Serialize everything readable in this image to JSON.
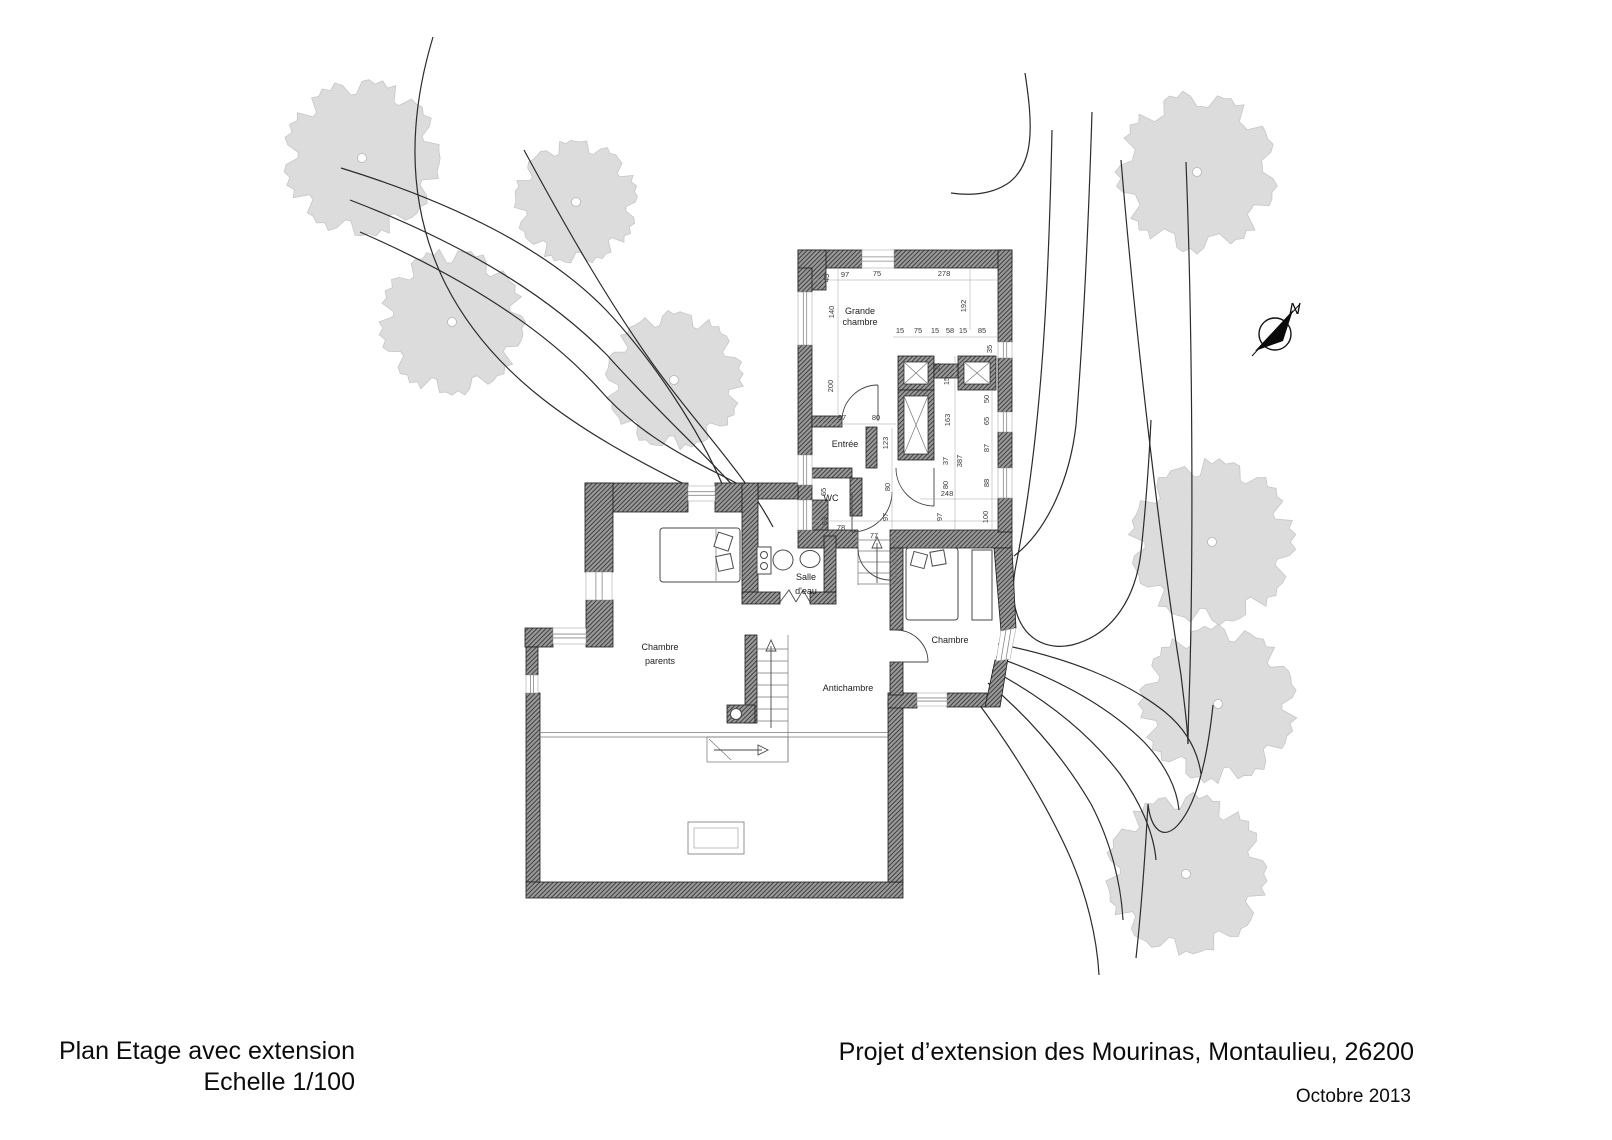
{
  "page": {
    "plan_title_line1": "Plan Etage avec extension",
    "plan_title_line2": "Echelle 1/100",
    "project_title": "Projet d’extension des Mourinas, Montaulieu, 26200",
    "date": "Octobre 2013"
  },
  "compass": {
    "label": "N"
  },
  "room_labels": [
    {
      "lines": [
        "Grande",
        "chambre"
      ],
      "x": 860,
      "y": 314,
      "lh": 11
    },
    {
      "lines": [
        "Entrée"
      ],
      "x": 845,
      "y": 447,
      "lh": 11
    },
    {
      "lines": [
        "WC"
      ],
      "x": 831,
      "y": 501,
      "lh": 11
    },
    {
      "lines": [
        "Salle",
        "d'eau"
      ],
      "x": 806,
      "y": 580,
      "lh": 14
    },
    {
      "lines": [
        "Chambre",
        "parents"
      ],
      "x": 660,
      "y": 650,
      "lh": 14
    },
    {
      "lines": [
        "Antichambre"
      ],
      "x": 848,
      "y": 691,
      "lh": 11
    },
    {
      "lines": [
        "Chambre"
      ],
      "x": 950,
      "y": 643,
      "lh": 11
    }
  ],
  "dimensions": [
    {
      "t": "43",
      "x": 829,
      "y": 278,
      "v": 1
    },
    {
      "t": "97",
      "x": 845,
      "y": 277
    },
    {
      "t": "75",
      "x": 877,
      "y": 276
    },
    {
      "t": "278",
      "x": 944,
      "y": 276
    },
    {
      "t": "140",
      "x": 834,
      "y": 312,
      "v": 1
    },
    {
      "t": "192",
      "x": 966,
      "y": 306,
      "v": 1
    },
    {
      "t": "200",
      "x": 833,
      "y": 386,
      "v": 1
    },
    {
      "t": "15",
      "x": 900,
      "y": 333
    },
    {
      "t": "75",
      "x": 918,
      "y": 333
    },
    {
      "t": "15",
      "x": 935,
      "y": 333
    },
    {
      "t": "58",
      "x": 950,
      "y": 333
    },
    {
      "t": "15",
      "x": 963,
      "y": 333
    },
    {
      "t": "85",
      "x": 982,
      "y": 333
    },
    {
      "t": "35",
      "x": 992,
      "y": 349,
      "v": 1
    },
    {
      "t": "25",
      "x": 940,
      "y": 367,
      "v": 1
    },
    {
      "t": "15",
      "x": 949,
      "y": 381,
      "v": 1
    },
    {
      "t": "97",
      "x": 842,
      "y": 420
    },
    {
      "t": "80",
      "x": 876,
      "y": 420
    },
    {
      "t": "123",
      "x": 888,
      "y": 443,
      "v": 1
    },
    {
      "t": "163",
      "x": 950,
      "y": 420,
      "v": 1
    },
    {
      "t": "37",
      "x": 948,
      "y": 461,
      "v": 1
    },
    {
      "t": "387",
      "x": 962,
      "y": 461,
      "v": 1
    },
    {
      "t": "80",
      "x": 890,
      "y": 487,
      "v": 1
    },
    {
      "t": "80",
      "x": 948,
      "y": 485,
      "v": 1
    },
    {
      "t": "248",
      "x": 947,
      "y": 496
    },
    {
      "t": "50",
      "x": 989,
      "y": 399,
      "v": 1
    },
    {
      "t": "65",
      "x": 989,
      "y": 421,
      "v": 1
    },
    {
      "t": "87",
      "x": 989,
      "y": 448,
      "v": 1
    },
    {
      "t": "88",
      "x": 989,
      "y": 483,
      "v": 1
    },
    {
      "t": "65",
      "x": 826,
      "y": 492,
      "v": 1
    },
    {
      "t": "83",
      "x": 827,
      "y": 521,
      "v": 1
    },
    {
      "t": "78",
      "x": 841,
      "y": 530
    },
    {
      "t": "97",
      "x": 888,
      "y": 517,
      "v": 1
    },
    {
      "t": "77",
      "x": 874,
      "y": 538
    },
    {
      "t": "97",
      "x": 942,
      "y": 517,
      "v": 1
    },
    {
      "t": "100",
      "x": 988,
      "y": 517,
      "v": 1
    }
  ],
  "trees": [
    {
      "x": 362,
      "y": 158,
      "r": 80
    },
    {
      "x": 576,
      "y": 202,
      "r": 63
    },
    {
      "x": 452,
      "y": 322,
      "r": 74
    },
    {
      "x": 674,
      "y": 380,
      "r": 70
    },
    {
      "x": 1197,
      "y": 172,
      "r": 82
    },
    {
      "x": 1212,
      "y": 542,
      "r": 84
    },
    {
      "x": 1218,
      "y": 704,
      "r": 80
    },
    {
      "x": 1186,
      "y": 874,
      "r": 82
    }
  ],
  "contours": [
    "M 433,37 C 408,120 406,205 446,285 C 492,375 575,430 688,486",
    "M 341,168 C 455,203 548,250 606,310 C 655,362 700,432 723,486",
    "M 350,200 C 462,243 548,295 607,355 C 656,410 707,456 734,487",
    "M 360,232 C 470,280 548,332 600,390 C 650,447 716,470 743,487",
    "M 524,150 C 570,235 608,300 650,360 C 692,420 744,472 773,527",
    "M 1025,73 C 1033,125 1035,165 1007,184 C 988,196 965,195 951,193",
    "M 1052,130 C 1049,270 1043,430 1016,565 C 1004,625 1035,653 1072,645 C 1115,634 1136,595 1141,552 C 1146,505 1149,462 1151,420",
    "M 1092,112 C 1088,240 1082,350 1076,425 C 1070,478 1048,530 1014,556",
    "M 1121,160 C 1136,340 1161,550 1181,675 C 1185,710 1188,730 1188,744",
    "M 1186,162 C 1193,340 1193,550 1190,670 C 1189,705 1188,728 1188,744",
    "M 1213,705 C 1207,762 1196,806 1177,826 C 1163,840 1151,830 1148,804 C 1145,858 1141,912 1136,958",
    "M 998,644 C 1065,657 1125,680 1165,712 C 1188,731 1198,753 1201,774",
    "M 996,657 C 1056,678 1108,706 1144,742 C 1166,765 1177,789 1179,810",
    "M 992,670 C 1044,698 1088,732 1120,774 C 1143,806 1154,836 1156,860",
    "M 988,683 C 1030,718 1064,758 1091,804 C 1111,842 1121,884 1123,920",
    "M 976,700 C 1010,746 1042,796 1067,850 C 1087,894 1097,938 1099,975"
  ],
  "colors": {
    "tree_fill": "#dcdcdc",
    "tree_edge": "#c6c6c6",
    "wall_fill": "#9a9a9a",
    "wall_hatch": "#454545",
    "contour": "#2b2b2b",
    "dim_text": "#3a3a3a",
    "label_text": "#222222"
  }
}
